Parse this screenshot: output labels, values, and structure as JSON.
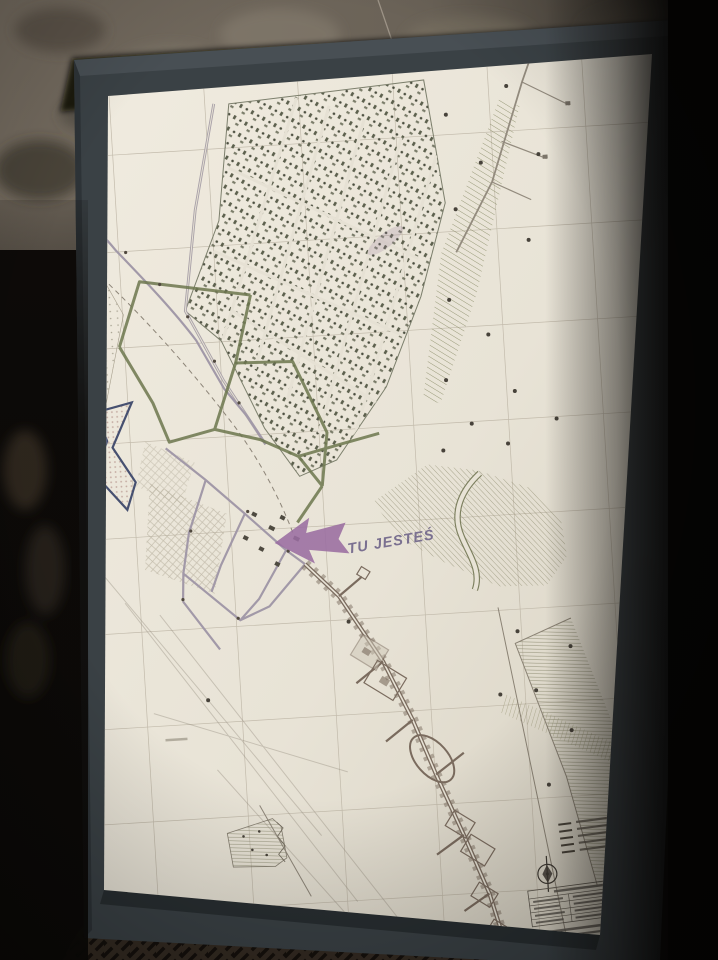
{
  "map": {
    "you_are_here_label": "TU JESTEŚ",
    "marker_color": "#9a6da1",
    "route_color": "#6d774e",
    "paper_color": "#e8e3d6",
    "frame_color": "#3a4145",
    "grid_color": "#b9b1a1",
    "gallery_color": "#7a6b5e",
    "navy_area_color": "#465070",
    "icons": {
      "you_are_here": "you-are-here-arrow",
      "compass": "compass-rose"
    },
    "legend": {
      "rows": 5,
      "readable": false
    },
    "title_block": {
      "rows": 4,
      "readable": false
    }
  }
}
